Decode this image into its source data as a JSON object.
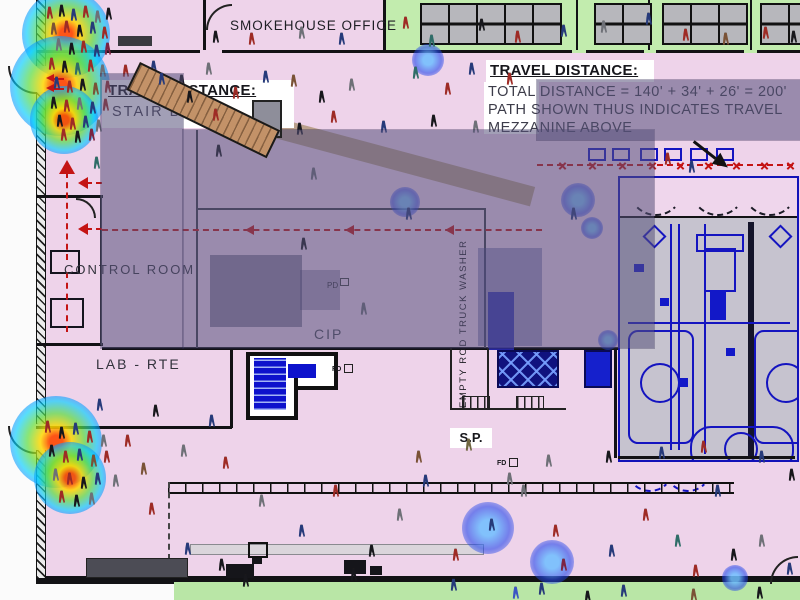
{
  "labels": {
    "smokehouse": "SMOKEHOUSE OFFICE",
    "control_room": "CONTROL ROOM",
    "lab_rte": "LAB - RTE",
    "cip": "CIP",
    "pd": "PD",
    "empty_rod_washer": "EMPTY ROD TRUCK WASHER",
    "sp": "S.P.",
    "fd_a": "FD",
    "fd_b": "FD"
  },
  "travel_note_left": {
    "title": "TRAVEL DISTANCE:",
    "line2": "STAIR B EXIT"
  },
  "travel_note_right": {
    "title": "TRAVEL DISTANCE:",
    "line1": "TOTAL DISTANCE = 140' + 34' + 26' = 200'",
    "line2": "PATH SHOWN THUS INDICATES TRAVEL",
    "line3": "MEZZANINE ABOVE"
  },
  "colors": {
    "floor_pink": "#eed3ea",
    "room_green": "#c2ecae",
    "machinery_gray": "#c6c3cf",
    "overlay_dim": "rgba(86,80,122,0.55)",
    "egress_red": "#c41414",
    "cad_blue": "#1414c0",
    "stair_tan": "#c39268",
    "wall_black": "#121215"
  },
  "palette": {
    "r": "#9e2b25",
    "n": "#263a7a",
    "k": "#17171c",
    "g": "#6e7077",
    "t": "#2f6d68",
    "m": "#7c2342",
    "o": "#6f6540",
    "b": "#3b55c4",
    "d": "#7a5236"
  },
  "people": [
    [
      46,
      4,
      "r"
    ],
    [
      58,
      2,
      "k"
    ],
    [
      70,
      6,
      "n"
    ],
    [
      82,
      3,
      "r"
    ],
    [
      94,
      8,
      "g"
    ],
    [
      105,
      5,
      "k"
    ],
    [
      50,
      20,
      "d"
    ],
    [
      63,
      18,
      "r"
    ],
    [
      76,
      22,
      "k"
    ],
    [
      89,
      19,
      "n"
    ],
    [
      101,
      24,
      "r"
    ],
    [
      55,
      36,
      "g"
    ],
    [
      68,
      40,
      "k"
    ],
    [
      80,
      38,
      "r"
    ],
    [
      93,
      42,
      "n"
    ],
    [
      104,
      40,
      "m"
    ],
    [
      48,
      55,
      "r"
    ],
    [
      61,
      58,
      "k"
    ],
    [
      74,
      60,
      "t"
    ],
    [
      87,
      57,
      "r"
    ],
    [
      99,
      62,
      "g"
    ],
    [
      53,
      74,
      "n"
    ],
    [
      66,
      78,
      "r"
    ],
    [
      79,
      76,
      "k"
    ],
    [
      92,
      80,
      "d"
    ],
    [
      104,
      78,
      "r"
    ],
    [
      50,
      94,
      "k"
    ],
    [
      63,
      97,
      "r"
    ],
    [
      76,
      95,
      "g"
    ],
    [
      89,
      99,
      "n"
    ],
    [
      102,
      96,
      "r"
    ],
    [
      56,
      112,
      "k"
    ],
    [
      69,
      115,
      "r"
    ],
    [
      82,
      113,
      "n"
    ],
    [
      95,
      117,
      "g"
    ],
    [
      60,
      126,
      "r"
    ],
    [
      74,
      128,
      "k"
    ],
    [
      88,
      126,
      "m"
    ],
    [
      212,
      28,
      "k"
    ],
    [
      248,
      30,
      "r"
    ],
    [
      298,
      24,
      "g"
    ],
    [
      338,
      30,
      "n"
    ],
    [
      402,
      14,
      "r"
    ],
    [
      428,
      32,
      "t"
    ],
    [
      478,
      16,
      "k"
    ],
    [
      514,
      28,
      "r"
    ],
    [
      560,
      22,
      "n"
    ],
    [
      600,
      18,
      "g"
    ],
    [
      645,
      10,
      "n"
    ],
    [
      682,
      26,
      "r"
    ],
    [
      722,
      30,
      "d"
    ],
    [
      762,
      24,
      "r"
    ],
    [
      790,
      28,
      "k"
    ],
    [
      122,
      62,
      "r"
    ],
    [
      150,
      58,
      "n"
    ],
    [
      178,
      72,
      "k"
    ],
    [
      205,
      60,
      "g"
    ],
    [
      232,
      84,
      "r"
    ],
    [
      262,
      68,
      "n"
    ],
    [
      290,
      72,
      "d"
    ],
    [
      318,
      88,
      "k"
    ],
    [
      348,
      76,
      "g"
    ],
    [
      380,
      118,
      "n"
    ],
    [
      412,
      64,
      "t"
    ],
    [
      430,
      112,
      "k"
    ],
    [
      444,
      80,
      "r"
    ],
    [
      468,
      60,
      "n"
    ],
    [
      472,
      118,
      "g"
    ],
    [
      330,
      108,
      "r"
    ],
    [
      296,
      120,
      "k"
    ],
    [
      506,
      70,
      "r"
    ],
    [
      93,
      154,
      "t"
    ],
    [
      215,
      142,
      "k"
    ],
    [
      310,
      165,
      "g"
    ],
    [
      405,
      205,
      "n"
    ],
    [
      300,
      235,
      "k"
    ],
    [
      570,
      205,
      "n"
    ],
    [
      360,
      300,
      "g"
    ],
    [
      664,
      150,
      "r"
    ],
    [
      688,
      158,
      "n"
    ],
    [
      96,
      396,
      "n"
    ],
    [
      124,
      432,
      "r"
    ],
    [
      152,
      402,
      "k"
    ],
    [
      180,
      442,
      "g"
    ],
    [
      208,
      412,
      "n"
    ],
    [
      222,
      454,
      "r"
    ],
    [
      140,
      460,
      "d"
    ],
    [
      44,
      418,
      "r"
    ],
    [
      58,
      424,
      "k"
    ],
    [
      72,
      420,
      "n"
    ],
    [
      86,
      428,
      "r"
    ],
    [
      100,
      432,
      "g"
    ],
    [
      48,
      442,
      "k"
    ],
    [
      62,
      448,
      "r"
    ],
    [
      76,
      446,
      "n"
    ],
    [
      90,
      452,
      "d"
    ],
    [
      103,
      448,
      "r"
    ],
    [
      52,
      466,
      "g"
    ],
    [
      66,
      470,
      "r"
    ],
    [
      80,
      474,
      "k"
    ],
    [
      94,
      470,
      "n"
    ],
    [
      58,
      488,
      "r"
    ],
    [
      73,
      492,
      "k"
    ],
    [
      88,
      490,
      "g"
    ],
    [
      465,
      436,
      "o"
    ],
    [
      545,
      452,
      "g"
    ],
    [
      605,
      448,
      "k"
    ],
    [
      658,
      444,
      "n"
    ],
    [
      700,
      438,
      "r"
    ],
    [
      758,
      448,
      "n"
    ],
    [
      788,
      466,
      "k"
    ],
    [
      415,
      448,
      "d"
    ],
    [
      112,
      472,
      "g"
    ],
    [
      148,
      500,
      "r"
    ],
    [
      184,
      540,
      "n"
    ],
    [
      218,
      556,
      "k"
    ],
    [
      258,
      492,
      "g"
    ],
    [
      298,
      522,
      "n"
    ],
    [
      332,
      482,
      "r"
    ],
    [
      368,
      542,
      "k"
    ],
    [
      396,
      506,
      "g"
    ],
    [
      422,
      472,
      "n"
    ],
    [
      452,
      546,
      "r"
    ],
    [
      488,
      516,
      "n"
    ],
    [
      520,
      482,
      "g"
    ],
    [
      552,
      522,
      "r"
    ],
    [
      560,
      556,
      "m"
    ],
    [
      608,
      542,
      "n"
    ],
    [
      642,
      506,
      "r"
    ],
    [
      674,
      532,
      "t"
    ],
    [
      692,
      562,
      "r"
    ],
    [
      714,
      482,
      "n"
    ],
    [
      730,
      546,
      "k"
    ],
    [
      758,
      532,
      "g"
    ],
    [
      786,
      560,
      "n"
    ],
    [
      242,
      572,
      "k"
    ],
    [
      450,
      576,
      "n"
    ],
    [
      350,
      566,
      "k"
    ],
    [
      506,
      470,
      "g"
    ],
    [
      512,
      584,
      "b"
    ],
    [
      538,
      580,
      "n"
    ],
    [
      584,
      588,
      "k"
    ],
    [
      620,
      582,
      "n"
    ],
    [
      756,
      584,
      "k"
    ],
    [
      690,
      586,
      "d"
    ]
  ],
  "stair_people": [
    [
      158,
      70,
      "n"
    ],
    [
      186,
      88,
      "k"
    ],
    [
      212,
      106,
      "r"
    ]
  ],
  "heat": {
    "rainbow": [
      [
        66,
        34,
        44
      ],
      [
        60,
        86,
        50
      ],
      [
        64,
        120,
        34
      ],
      [
        56,
        442,
        46
      ],
      [
        70,
        478,
        36
      ]
    ],
    "blue": [
      [
        428,
        60,
        16
      ],
      [
        225,
        112,
        13
      ],
      [
        405,
        202,
        15
      ],
      [
        578,
        200,
        17
      ],
      [
        592,
        228,
        11
      ],
      [
        488,
        528,
        26
      ],
      [
        552,
        562,
        22
      ],
      [
        735,
        578,
        13
      ],
      [
        608,
        340,
        10
      ]
    ]
  },
  "tables_x": [
    420,
    448,
    476,
    504,
    532,
    594,
    622,
    662,
    690,
    718,
    760,
    788
  ],
  "red_x": [
    [
      558,
      161
    ],
    [
      588,
      161
    ],
    [
      618,
      161
    ],
    [
      648,
      161
    ],
    [
      676,
      161
    ],
    [
      704,
      161
    ],
    [
      732,
      161
    ],
    [
      760,
      161
    ],
    [
      786,
      161
    ]
  ]
}
